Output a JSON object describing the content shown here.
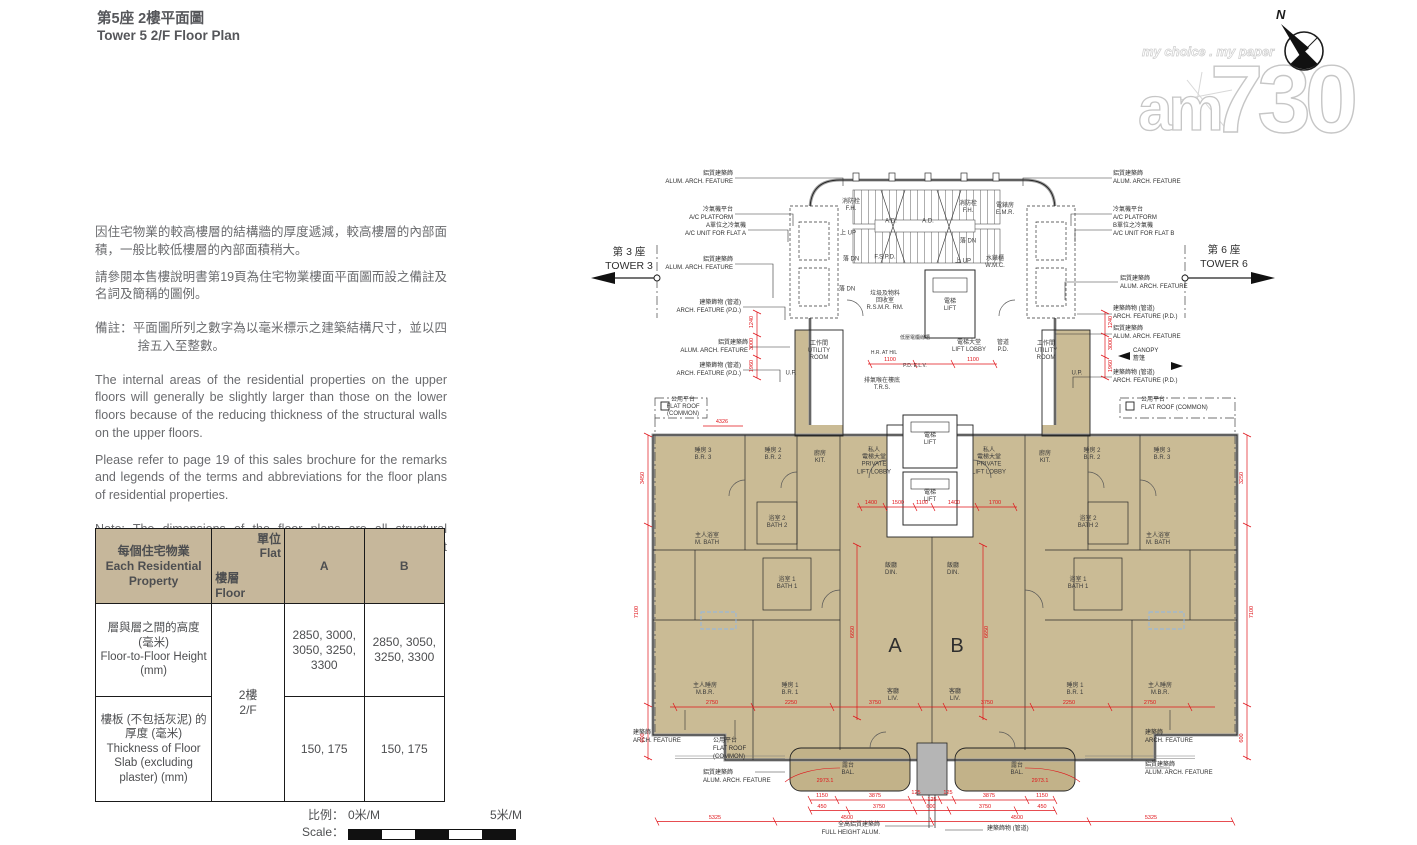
{
  "page": {
    "title_zh": "第5座 2樓平面圖",
    "title_en": "Tower 5 2/F Floor Plan"
  },
  "logo": {
    "tagline": "my choice . my paper",
    "brand_am": "am",
    "brand_730": "730"
  },
  "compass": {
    "north": "N"
  },
  "notes_zh": {
    "p1": "因住宅物業的較高樓層的結構牆的厚度遞減，較高樓層的內部面積，一般比較低樓層的內部面積稍大。",
    "p2": "請參閱本售樓說明書第19頁為住宅物業樓面平面圖而設之備註及名詞及簡稱的圖例。",
    "p3": "備註：平面圖所列之數字為以毫米標示之建築結構尺寸，並以四捨五入至整數。"
  },
  "notes_en": {
    "p1": "The internal areas of the residential properties on the upper floors will generally be slightly larger than those on the lower floors because of the reducing thickness of the structural walls on the upper floors.",
    "p2": "Please refer to page 19 of this sales brochure for the remarks and legends of the terms and abbreviations for the floor plans of residential properties.",
    "p3": "Note: The dimensions of the floor plans are all structural dimensions in millimeter and rounded off to the nearest integer."
  },
  "table": {
    "corner_zh": "每個住宅物業",
    "corner_en": "Each Residential Property",
    "flat_zh": "單位",
    "flat_en": "Flat",
    "floor_zh": "樓層",
    "floor_en": "Floor",
    "colA": "A",
    "colB": "B",
    "floor_value_zh": "2樓",
    "floor_value_en": "2/F",
    "row1_zh": "層與層之間的高度 (毫米)",
    "row1_en": "Floor-to-Floor Height (mm)",
    "row1_a": "2850, 3000, 3050, 3250, 3300",
    "row1_b": "2850, 3050, 3250, 3300",
    "row2_zh": "樓板 (不包括灰泥) 的厚度 (毫米)",
    "row2_en": "Thickness of Floor Slab (excluding plaster) (mm)",
    "row2_a": "150, 175",
    "row2_b": "150, 175"
  },
  "scale": {
    "label_zh": "比例：",
    "label_en": "Scale：",
    "v0": "0米/M",
    "v5": "5米/M"
  },
  "plan": {
    "towers": {
      "t3_zh": "第 3 座",
      "t3_en": "TOWER 3",
      "t6_zh": "第 6 座",
      "t6_en": "TOWER 6"
    },
    "labels": {
      "br3": {
        "zh": "睡房 3",
        "en": "B.R. 3"
      },
      "br2": {
        "zh": "睡房 2",
        "en": "B.R. 2"
      },
      "br1": {
        "zh": "睡房 1",
        "en": "B.R. 1"
      },
      "mbr": {
        "zh": "主人睡房",
        "en": "M.B.R."
      },
      "kit": {
        "zh": "廚房",
        "en": "KIT."
      },
      "util": {
        "zh": "工作間",
        "en": "UTILITY ROOM"
      },
      "up_platform": "U.P.",
      "pll": {
        "zh1": "私人",
        "zh2": "電梯大堂",
        "en1": "PRIVATE",
        "en2": "LIFT LOBBY"
      },
      "mbath": {
        "zh": "主人浴室",
        "en": "M. BATH"
      },
      "bath1": {
        "zh": "浴室 1",
        "en": "BATH 1"
      },
      "bath2": {
        "zh": "浴室 2",
        "en": "BATH 2"
      },
      "din": {
        "zh": "飯廳",
        "en": "DIN."
      },
      "liv": {
        "zh": "客廳",
        "en": "LIV."
      },
      "bal": {
        "zh": "露台",
        "en": "BAL."
      },
      "flat_a": "A",
      "flat_b": "B",
      "lift": {
        "zh": "電梯",
        "en": "LIFT"
      },
      "lift_lobby": {
        "zh": "電梯大堂",
        "en": "LIFT LOBBY"
      },
      "emr": {
        "zh": "電錶房",
        "en": "E.M.R."
      },
      "wmc": {
        "zh": "水錶櫃",
        "en": "W.M.C."
      },
      "fh": {
        "zh": "消防栓",
        "en": "F.H."
      },
      "rsmr": {
        "zh1": "垃圾及物料",
        "zh2": "回收室",
        "en": "R.S.M.R. RM."
      },
      "fspd": "F.S.P.D.",
      "ad": "A.D.",
      "up": {
        "zh": "上",
        "en": "UP"
      },
      "dn": {
        "zh": "落",
        "en": "DN"
      },
      "trs": {
        "zh": "排氣喉在樓底",
        "en": "T.R.S."
      },
      "hr": "H.R. AT H/L",
      "pd": {
        "zh": "管道",
        "en": "P.D."
      },
      "elv": "P.D.  E.L.V.",
      "lv": "低壓電纜線槽",
      "canopy": {
        "zh": "簷篷",
        "en": "CANOPY"
      },
      "flat_roof": {
        "zh": "公用平台",
        "en": "FLAT ROOF",
        "common": "(COMMON)"
      },
      "flat_roof_inline": "FLAT ROOF (COMMON)",
      "arch": {
        "zh": "建築飾",
        "en": "ARCH. FEATURE"
      },
      "alum": {
        "zh": "鋁質建築飾",
        "en": "ALUM. ARCH. FEATURE"
      },
      "arch_pd": {
        "zh": "建築飾物 (管道)",
        "en": "ARCH. FEATURE (P.D.)"
      },
      "acp": {
        "zh": "冷氣機平台",
        "en": "A/C PLATFORM"
      },
      "ac_a": {
        "zh": "A單位之冷氣機",
        "en": "A/C UNIT FOR FLAT A"
      },
      "ac_b": {
        "zh": "B單位之冷氣機",
        "en": "A/C UNIT FOR FLAT B"
      },
      "full_height": {
        "zh": "全高鋁質建築飾",
        "en": "FULL HEIGHT ALUM."
      },
      "arch_pd_short": "建築飾物 (管道)"
    },
    "dims": {
      "bottom1": [
        "1150",
        "3875",
        "125",
        "125",
        "125",
        "3875",
        "1150"
      ],
      "bottom2": [
        "450",
        "3750",
        "600",
        "3750",
        "450"
      ],
      "bottom3": [
        "5325",
        "4500",
        "4500",
        "5325"
      ],
      "curve": "2973.1",
      "side_left": [
        "3450",
        "7100",
        "600"
      ],
      "side_right": [
        "3250",
        "7100",
        "600"
      ],
      "inner_v": "6650",
      "row_a": [
        "2750",
        "2250",
        "3750",
        "3750",
        "2250",
        "2750"
      ],
      "row_b": [
        "1400",
        "1500",
        "1100",
        "1400",
        "1700"
      ],
      "row_c": [
        "1100",
        "1100"
      ],
      "stack": [
        "1240",
        "3000",
        "1960"
      ],
      "top_left": "4326"
    },
    "colors": {
      "room_fill": "#cabb95",
      "balcony_fill": "#c2b289",
      "dim_red": "#e01319"
    }
  }
}
